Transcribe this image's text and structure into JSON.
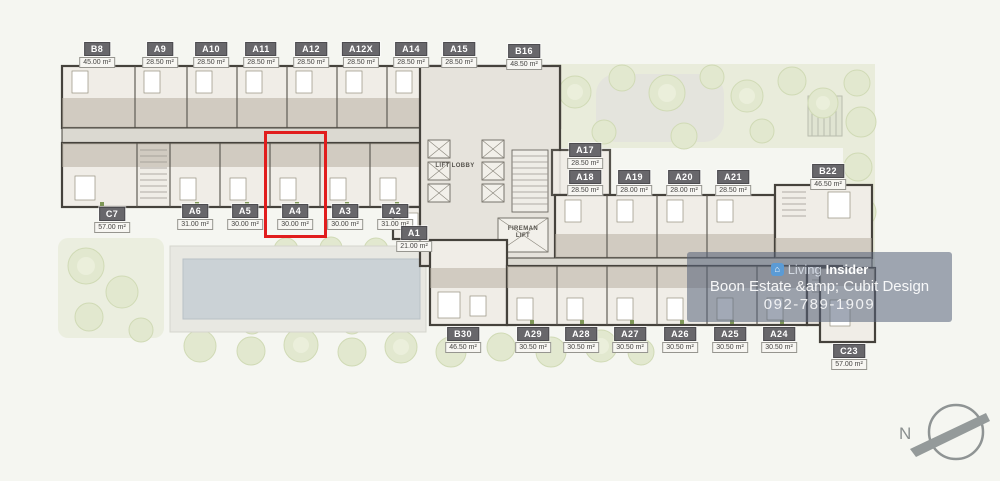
{
  "units": [
    {
      "name": "B8",
      "area": "45.00 m²"
    },
    {
      "name": "A9",
      "area": "28.50 m²"
    },
    {
      "name": "A10",
      "area": "28.50 m²"
    },
    {
      "name": "A11",
      "area": "28.50 m²"
    },
    {
      "name": "A12",
      "area": "28.50 m²"
    },
    {
      "name": "A12X",
      "area": "28.50 m²"
    },
    {
      "name": "A14",
      "area": "28.50 m²"
    },
    {
      "name": "A15",
      "area": "28.50 m²"
    },
    {
      "name": "B16",
      "area": "48.50 m²"
    },
    {
      "name": "C7",
      "area": "57.00 m²"
    },
    {
      "name": "A6",
      "area": "31.00 m²"
    },
    {
      "name": "A5",
      "area": "30.00 m²"
    },
    {
      "name": "A4",
      "area": "30.00 m²",
      "highlighted": true
    },
    {
      "name": "A3",
      "area": "30.00 m²"
    },
    {
      "name": "A2",
      "area": "31.00 m²"
    },
    {
      "name": "A1",
      "area": "21.00 m²"
    },
    {
      "name": "A17",
      "area": "28.50 m²"
    },
    {
      "name": "A18",
      "area": "28.50 m²"
    },
    {
      "name": "A19",
      "area": "28.00 m²"
    },
    {
      "name": "A20",
      "area": "28.00 m²"
    },
    {
      "name": "A21",
      "area": "28.50 m²"
    },
    {
      "name": "B22",
      "area": "46.50 m²"
    },
    {
      "name": "B30",
      "area": "46.50 m²"
    },
    {
      "name": "A29",
      "area": "30.50 m²"
    },
    {
      "name": "A28",
      "area": "30.50 m²"
    },
    {
      "name": "A27",
      "area": "30.50 m²"
    },
    {
      "name": "A26",
      "area": "30.50 m²"
    },
    {
      "name": "A25",
      "area": "30.50 m²"
    },
    {
      "name": "A24",
      "area": "30.50 m²"
    },
    {
      "name": "C23",
      "area": "57.00 m²"
    }
  ],
  "core": {
    "lift_lobby": "LIFT LOBBY",
    "fireman_lift": "FIREMAN LIFT"
  },
  "watermark": {
    "brand_light": "Living",
    "brand_bold": "Insider",
    "logo_glyph": "⌂",
    "company": "Boon Estate &amp; Cubit Design",
    "phone": "092-789-1909"
  },
  "compass": {
    "north_label": "N"
  },
  "colors": {
    "highlight_box": "#e11d1d",
    "label_badge_bg": "#68676b",
    "watermark_band": "rgba(86,99,122,0.55)",
    "pool": "#cbd2d6"
  }
}
